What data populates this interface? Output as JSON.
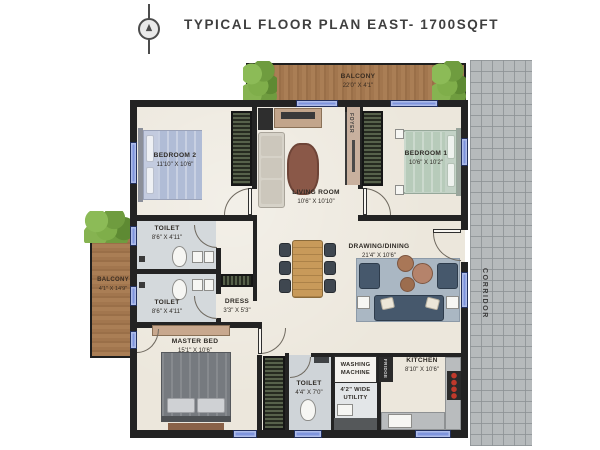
{
  "header": {
    "title": "TYPICAL FLOOR PLAN EAST- 1700SQFT",
    "compass_icon": "north-compass"
  },
  "corridor": {
    "label": "CORRIDOR"
  },
  "balconies": {
    "top": {
      "label": "BALCONY",
      "dims": "22'0\" X 4'1\""
    },
    "left": {
      "label": "BALCONY",
      "dims": "4'1\" X 14'9\""
    }
  },
  "rooms": {
    "bedroom2": {
      "label": "BEDROOM 2",
      "dims": "11'10\" X 10'6\""
    },
    "living_room": {
      "label": "LIVING ROOM",
      "dims": "10'6\" X 10'10\""
    },
    "bedroom1": {
      "label": "BEDROOM 1",
      "dims": "10'6\" X 10'2\""
    },
    "foyer": {
      "label": "FOYER"
    },
    "toilet_top": {
      "label": "TOILET",
      "dims": "8'6\" X 4'11\""
    },
    "toilet_bottom": {
      "label": "TOILET",
      "dims": "8'6\" X 4'11\""
    },
    "dress": {
      "label": "DRESS",
      "dims": "3'3\" X 5'3\""
    },
    "drawing_dining": {
      "label": "DRAWING/DINING",
      "dims": "21'4\" X 10'6\""
    },
    "master_bed": {
      "label": "MASTER BED",
      "dims": "15'1\" X 10'6\""
    },
    "toilet_common": {
      "label": "TOILET",
      "dims": "4'4\" X 7'0\""
    },
    "washing": {
      "label": "WASHING MACHINE"
    },
    "utility": {
      "label": "4'2\" WIDE UTILITY"
    },
    "kitchen": {
      "label": "KITCHEN",
      "dims": "8'10\" X 10'6\""
    },
    "fridge": {
      "label": "FRIDGE"
    }
  },
  "colors": {
    "wall": "#232323",
    "floor": "#ece7dc",
    "balcony_wood": "#a87c52",
    "plant_green": "#7fae4a",
    "corridor_tile": "#b6babc",
    "window_blue": "#7e94dd",
    "sofa_blue": "#46586c",
    "stove_red": "#c0392b"
  }
}
